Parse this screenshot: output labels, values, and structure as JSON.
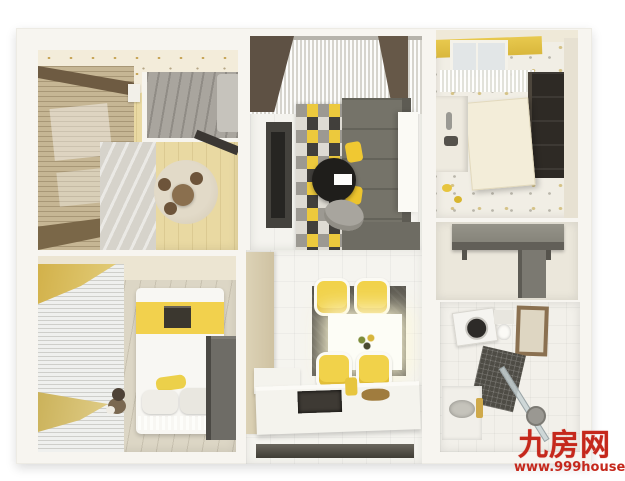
{
  "watermark": {
    "site_name": "九房网",
    "url": "www.999house.com",
    "color": "#c5281c"
  },
  "scene": {
    "type": "3d-rendered-apartment-floorplan-top-view",
    "rooms": [
      "bedroom-top-left",
      "bedroom-bottom-left",
      "living-room",
      "kitchen",
      "entry-hall",
      "bathroom",
      "dining-area"
    ],
    "palette": {
      "accent_yellow": "#f0ce44",
      "dark_gray": "#4a4842",
      "wood_floor": "#e9d9a2",
      "wall_white": "#f7f5f0",
      "drape_brown": "#5e5144",
      "rug_black": "#413f3b"
    }
  }
}
